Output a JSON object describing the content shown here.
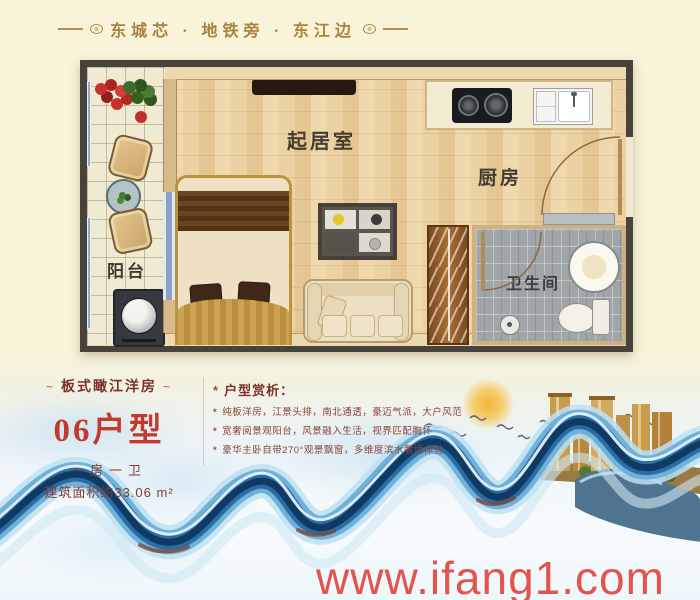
{
  "poster": {
    "background": "#f8f3d9",
    "header": {
      "title": "东城芯 · 地铁旁 · 东江边",
      "color": "#a8823f"
    },
    "floorplan": {
      "labels": {
        "living": "起居室",
        "kitchen": "厨房",
        "bathroom": "卫生间",
        "balcony": "阳台"
      }
    },
    "info": {
      "tagline": "板式瞰江洋房",
      "tagline_deco": "~",
      "unit": "06户型",
      "unit_color": "#c23a2e",
      "layout": "一房一卫",
      "area": "建筑面积约33.06 m²",
      "analysis_title": "户型赏析：",
      "bullet_marker": "*",
      "bullets": [
        "纯板洋房，江景头排，南北通透，豪迈气派，大户风范",
        "宽奢阅景观阳台，风景融入生活，视界匹配胸怀",
        "豪华主卧自带270°观景飘窗，多维度滨水奢境体验"
      ]
    },
    "watermark": {
      "text": "www.ifang1.com",
      "color": "#e4544c"
    }
  }
}
